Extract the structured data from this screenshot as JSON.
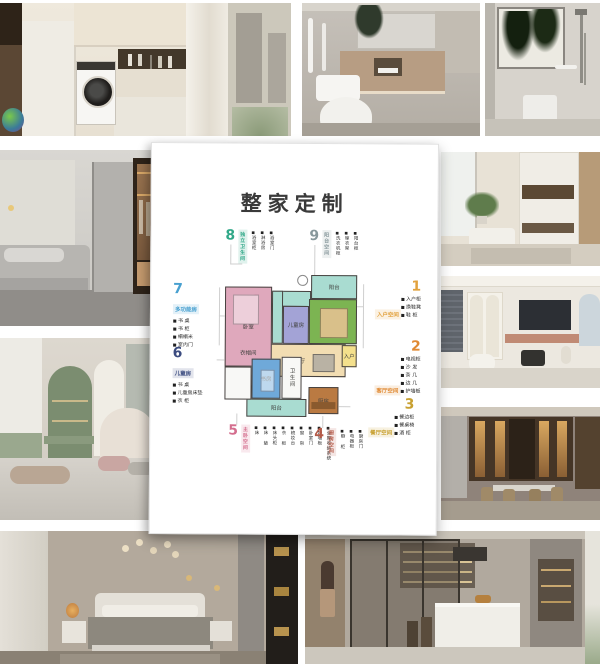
{
  "poster": {
    "title": "整家定制"
  },
  "palette": {
    "page_bg": "#ffffff",
    "card_bg": "#ffffff",
    "wall": "#474240"
  },
  "floor_plan": {
    "rooms": [
      {
        "id": "bedroom",
        "name": "卧室",
        "color": "#dfa8bc"
      },
      {
        "id": "cloakroom",
        "name": "衣帽间",
        "color": "#dfa8bc"
      },
      {
        "id": "bath-top",
        "name": "",
        "color": "#a9dcd1"
      },
      {
        "id": "balcony-top",
        "name": "阳台",
        "color": "#a9dcd1"
      },
      {
        "id": "kids",
        "name": "儿童房",
        "color": "#a3a3d6"
      },
      {
        "id": "living",
        "name": "客厅",
        "color": "#7cb452"
      },
      {
        "id": "dining",
        "name": "餐厅",
        "color": "#f2ddb2"
      },
      {
        "id": "entry",
        "name": "入户",
        "color": "#f4e08c"
      },
      {
        "id": "study",
        "name": "书房",
        "color": "#6fa9d9"
      },
      {
        "id": "bath-bottom",
        "name": "卫生间",
        "color": "#f8f8f6"
      },
      {
        "id": "kitchen",
        "name": "厨房",
        "color": "#ba7a42"
      },
      {
        "id": "balcony-bottom",
        "name": "阳台",
        "color": "#a9dcd1"
      },
      {
        "id": "utility",
        "name": "",
        "color": "#f8f8f6"
      }
    ]
  },
  "labels": [
    {
      "num": "1",
      "heading": "入户空间",
      "color": "#e2a23e",
      "items": [
        "入户柜",
        "换鞋凳",
        "鞋 柜"
      ]
    },
    {
      "num": "2",
      "heading": "客厅空间",
      "color": "#e08a34",
      "items": [
        "电视柜",
        "沙 发",
        "茶 几",
        "边 几",
        "护墙板"
      ]
    },
    {
      "num": "3",
      "heading": "餐厅空间",
      "color": "#c8a030",
      "items": [
        "餐边柜",
        "餐桌椅",
        "酒 柜"
      ]
    },
    {
      "num": "4",
      "heading": "厨房空间",
      "color": "#b45a48",
      "items": [
        "橱 柜",
        "电器柜",
        "厨房门"
      ]
    },
    {
      "num": "5",
      "heading": "主卧空间",
      "color": "#d46e8e",
      "items": [
        "床",
        "床 垫",
        "床头柜",
        "衣 柜",
        "梳妆台",
        "窗 帘",
        "卧室门",
        "护墙板",
        "全屋收纳系统"
      ]
    },
    {
      "num": "6",
      "heading": "儿童房",
      "color": "#3c4c80",
      "items": [
        "书 桌",
        "儿童房床垫",
        "衣 柜"
      ]
    },
    {
      "num": "7",
      "heading": "多功能房",
      "color": "#48a0d0",
      "items": [
        "书 桌",
        "书 柜",
        "榻榻米",
        "室内门"
      ]
    },
    {
      "num": "8",
      "heading": "独立卫生间",
      "color": "#30a888",
      "items": [
        "浴室柜",
        "淋浴房",
        "浴室门"
      ]
    },
    {
      "num": "9",
      "heading": "阳台空间",
      "color": "#88989c",
      "items": [
        "洗衣机柜",
        "晾衣架",
        "阳台柜"
      ]
    }
  ]
}
